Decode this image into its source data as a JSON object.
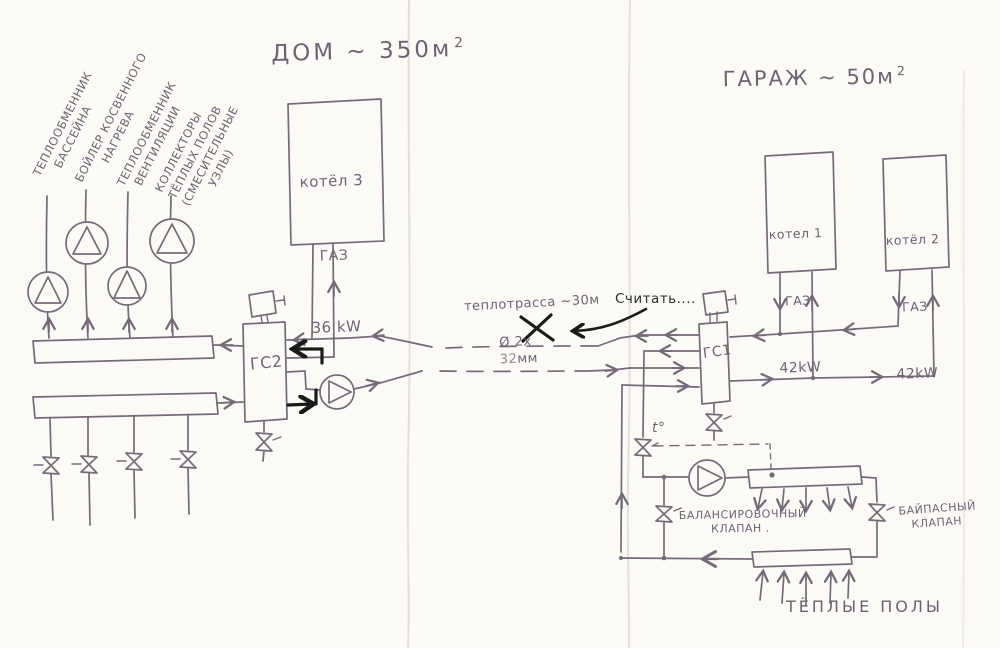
{
  "house": {
    "title": "ДОМ ~ 350м",
    "title_sup": "2",
    "load_labels": [
      "ТЕПЛООБМЕННИК\n    БАССЕЙНА",
      "БОЙЛЕР КОСВЕННОГО\n       НАГРЕВА",
      "ТЕПЛООБМЕННИК\n  ВЕНТИЛЯЦИИ",
      "КОЛЛЕКТОРЫ\nТЁПЛЫХ ПОЛОВ\n(СМЕСИТЕЛЬНЫЕ\n       УЗЛЫ)"
    ],
    "boiler3": {
      "name": "котёл 3",
      "fuel": "ГАЗ",
      "power": "36 kW"
    },
    "separator_label": "ГС2"
  },
  "garage": {
    "title": "ГАРАЖ ~ 50м",
    "title_sup": "2",
    "boiler1": {
      "name": "котел 1",
      "fuel": "ГАЗ",
      "power": "42kW"
    },
    "boiler2": {
      "name": "котёл 2",
      "fuel": "ГАЗ",
      "power": "42kW"
    },
    "separator_label": "ГС1",
    "thermo_valve_label": "t°",
    "balancing_valve_label": "БАЛАНСИРОВОЧНЫЙ\n        КЛАПАН .",
    "bypass_valve_label": "БАЙПАСНЫЙ\n   КЛАПАН",
    "warm_floor_label": "ТЁПЛЫЕ ПОЛЫ"
  },
  "heat_main": {
    "label": "теплотрасса ~30м",
    "diameter_prefix": "Ø 2х",
    "diameter_crossed_value": "32",
    "diameter_suffix": "мм",
    "note": "Считать...."
  },
  "colors": {
    "ink": "#776a78",
    "annotation": "#1a1a1a",
    "paper": "#fbfaf7"
  }
}
